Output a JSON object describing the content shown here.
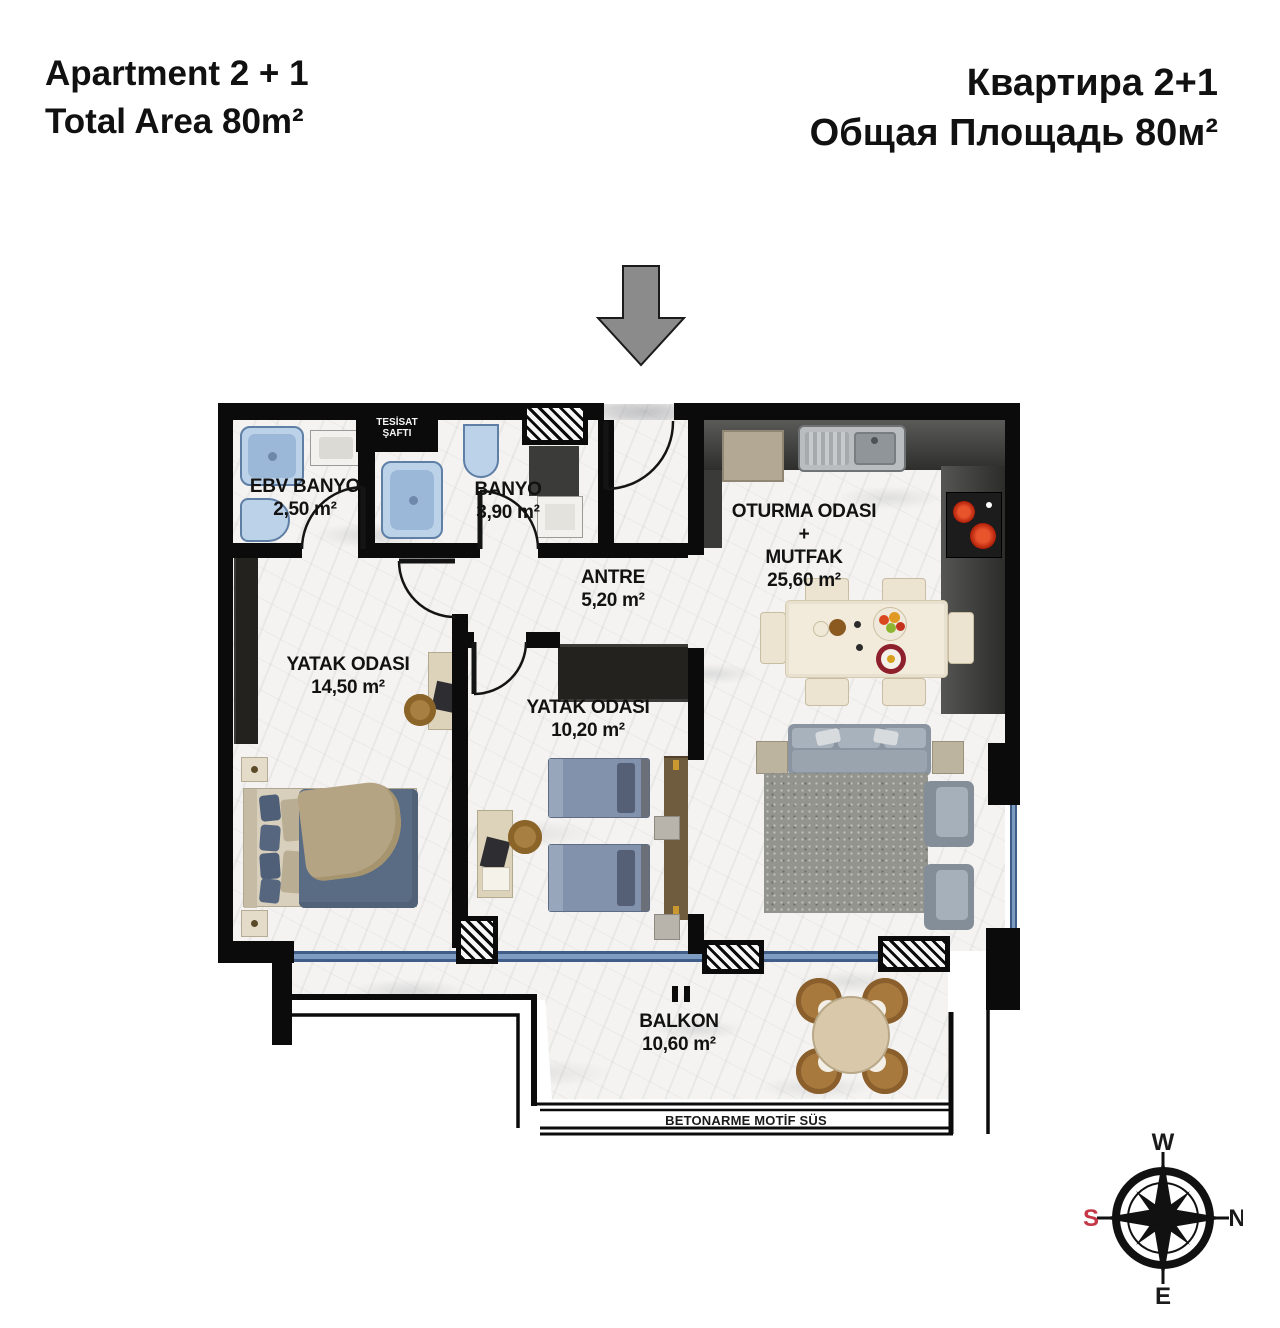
{
  "header": {
    "left": {
      "line1": "Apartment 2 + 1",
      "line2": "Total Area 80m²"
    },
    "right": {
      "line1": "Квартира 2+1",
      "line2": "Общая Площадь 80м²"
    }
  },
  "rooms": {
    "ebv_banyo": {
      "name": "EBV BANYO",
      "area": "2,50 m²"
    },
    "banyo": {
      "name": "BANYO",
      "area": "3,90 m²"
    },
    "antre": {
      "name": "ANTRE",
      "area": "5,20 m²"
    },
    "living": {
      "line1": "OTURMA ODASI +",
      "line2": "MUTFAK",
      "area": "25,60 m²"
    },
    "bedroom1": {
      "name": "YATAK ODASI",
      "area": "14,50 m²"
    },
    "bedroom2": {
      "name": "YATAK ODASI",
      "area": "10,20 m²"
    },
    "balcony": {
      "name": "BALKON",
      "area": "10,60 m²"
    },
    "shaft": {
      "line1": "TESİSAT",
      "line2": "ŞAFTI"
    }
  },
  "footer": {
    "note": "BETONARME MOTİF SÜS"
  },
  "compass": {
    "n": "N",
    "e": "E",
    "s": "S",
    "w": "W"
  },
  "colors": {
    "wall": "#0b0b0b",
    "window_blue": "#4c6e9c",
    "fixture_blue": "#bcd2e8",
    "compass_south_red": "#c43747",
    "arrow_gray": "#8b8b8b",
    "bed_navy": "#5a6c84",
    "counter_dark": "#3a3a38"
  }
}
